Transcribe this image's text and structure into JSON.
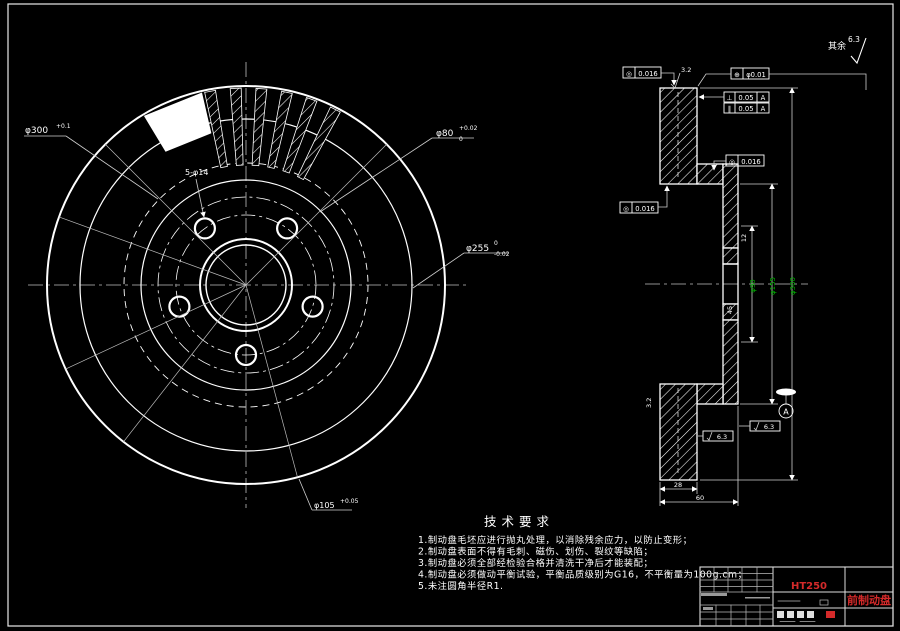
{
  "colors": {
    "background": "#000000",
    "line": "#ffffff",
    "dim_text": "#00b400",
    "accent_red": "#d42a2a"
  },
  "surface_note": {
    "label": "其余",
    "roughness": "6.3"
  },
  "front_view": {
    "dims": {
      "outer": {
        "text": "φ300",
        "sup": "+0.1",
        "sub": ""
      },
      "holes": {
        "text": "5-φ14"
      },
      "hub": {
        "text": "φ80",
        "sup": "+0.02",
        "sub": "0"
      },
      "friction": {
        "text": "φ255",
        "sup": "0",
        "sub": "-0.02"
      },
      "bolt_circle": {
        "text": "φ105",
        "sup": "+0.05"
      }
    },
    "geom": {
      "cx": 246,
      "cy": 285,
      "circles": [
        {
          "r": 199,
          "w": 2
        },
        {
          "r": 166,
          "w": 1.2
        },
        {
          "r": 122,
          "w": 0.9,
          "dash": "7 5"
        },
        {
          "r": 105,
          "w": 1.2
        },
        {
          "r": 88,
          "w": 0.8,
          "dash": "14 4 3 4"
        },
        {
          "r": 70,
          "w": 0.8,
          "dash": "14 4 3 4"
        },
        {
          "r": 46,
          "w": 2
        },
        {
          "r": 40,
          "w": 1.4
        }
      ],
      "bolt_circle_r": 70,
      "bolt_hole_r": 10,
      "bolt_angles": [
        270,
        342,
        54,
        126,
        198
      ],
      "vane_r1": 120,
      "vane_r2": 197,
      "vane_half": 1.6,
      "vane_angles": [
        63,
        70.5,
        78,
        85.5,
        93,
        100.5
      ],
      "solid_wedge": [
        103,
        121
      ],
      "solid_r1": 156,
      "radial_angles": [
        135,
        160,
        205,
        232,
        45,
        -75
      ]
    }
  },
  "section_view": {
    "dims": {
      "bore": "φ90",
      "hat": "φ155",
      "outer": "φ300",
      "wall": "12",
      "flange": "45",
      "thickness": "28",
      "width": "60"
    },
    "frames": [
      {
        "sym": "◎",
        "val": "0.016"
      },
      {
        "sym": "⊕",
        "val": "φ0.01"
      },
      {
        "sym": "⊥",
        "val": "0.05",
        "datum": "A"
      },
      {
        "sym": "∥",
        "val": "0.05",
        "datum": "A"
      },
      {
        "sym": "◎",
        "val": "0.016"
      },
      {
        "sym": "◎",
        "val": "0.016"
      }
    ],
    "datum_label": "A",
    "roughness": {
      "top": "3.2",
      "left": "3.2",
      "r1": "6.3",
      "r2": "6.3"
    }
  },
  "tech_req": {
    "title": "技术要求",
    "items": [
      "1.制动盘毛坯应进行抛丸处理，以消除残余应力，以防止变形；",
      "2.制动盘表面不得有毛刺、磁伤、划伤、裂纹等缺陷；",
      "3.制动盘必须全部经检验合格并清洗干净后才能装配；",
      "4.制动盘必须做动平衡试验，平衡品质级别为G16，不平衡量为100g.cm；",
      "5.未注圆角半径R1."
    ]
  },
  "title_block": {
    "material": "HT250",
    "part_name": "前制动盘"
  }
}
